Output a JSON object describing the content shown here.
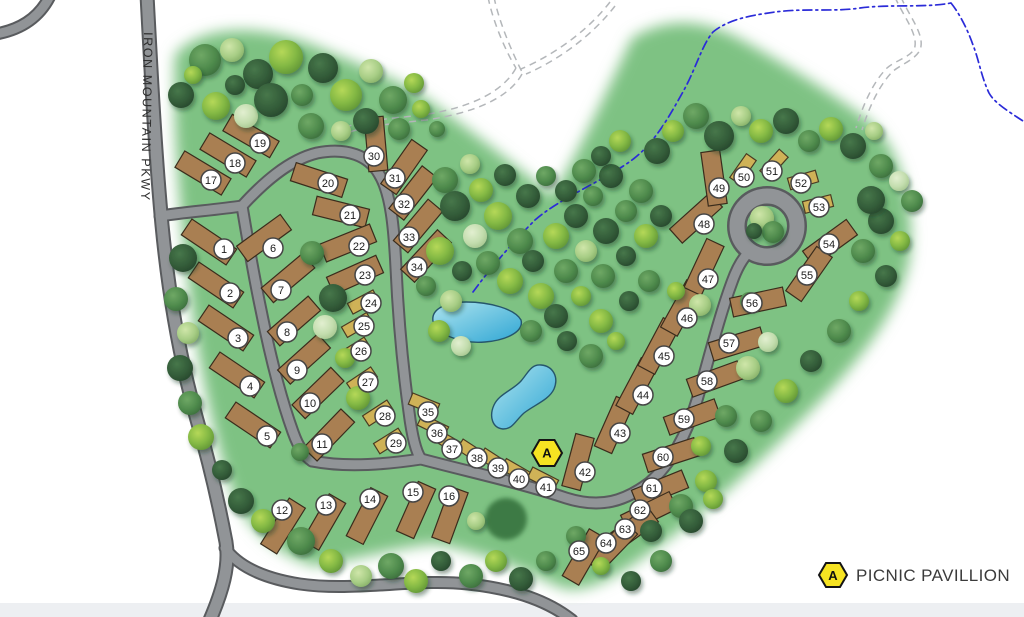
{
  "map": {
    "road_label": "IRON MOUNTAIN PKWY",
    "legend": {
      "marker": "A",
      "label": "PICNIC PAVILLION"
    },
    "pavilion": {
      "x": 547,
      "y": 453,
      "label": "A"
    },
    "colors": {
      "park_green": "#7ec283",
      "road_fill": "#919497",
      "road_casing": "#595b5e",
      "trail_gray": "#b4b7ba",
      "stream_blue": "#2b2bd8",
      "pond_light": "#9adeec",
      "pond_deep": "#2fa6d4",
      "rv_site": "#a97f52",
      "rv_site_stroke": "#3a2c1c",
      "tent_site": "#cfb257",
      "tent_site_stroke": "#4a3b22",
      "pavilion_yellow": "#f6e322",
      "label_circle_stroke": "#454545"
    },
    "sites": [
      {
        "n": "1",
        "x": 209,
        "y": 242,
        "rot": 34,
        "t": "rv",
        "lx": 224,
        "ly": 249
      },
      {
        "n": "2",
        "x": 216,
        "y": 285,
        "rot": 34,
        "t": "rv",
        "lx": 230,
        "ly": 293
      },
      {
        "n": "3",
        "x": 226,
        "y": 328,
        "rot": 34,
        "t": "rv",
        "lx": 238,
        "ly": 338
      },
      {
        "n": "4",
        "x": 237,
        "y": 375,
        "rot": 34,
        "t": "rv",
        "lx": 250,
        "ly": 386
      },
      {
        "n": "5",
        "x": 253,
        "y": 425,
        "rot": 34,
        "t": "rv",
        "lx": 267,
        "ly": 436
      },
      {
        "n": "6",
        "x": 264,
        "y": 238,
        "rot": -36,
        "t": "rv",
        "lx": 273,
        "ly": 248
      },
      {
        "n": "7",
        "x": 288,
        "y": 278,
        "rot": -40,
        "t": "rv",
        "lx": 281,
        "ly": 290
      },
      {
        "n": "8",
        "x": 294,
        "y": 321,
        "rot": -41,
        "t": "rv",
        "lx": 287,
        "ly": 332
      },
      {
        "n": "9",
        "x": 304,
        "y": 359,
        "rot": -42,
        "t": "rv",
        "lx": 297,
        "ly": 370
      },
      {
        "n": "10",
        "x": 318,
        "y": 393,
        "rot": -44,
        "t": "rv",
        "lx": 310,
        "ly": 403
      },
      {
        "n": "11",
        "x": 329,
        "y": 435,
        "rot": -46,
        "t": "rv",
        "lx": 322,
        "ly": 444
      },
      {
        "n": "12",
        "x": 283,
        "y": 526,
        "rot": -58,
        "t": "rv",
        "lx": 282,
        "ly": 510
      },
      {
        "n": "13",
        "x": 324,
        "y": 522,
        "rot": -60,
        "t": "rv",
        "lx": 326,
        "ly": 505
      },
      {
        "n": "14",
        "x": 367,
        "y": 516,
        "rot": -63,
        "t": "rv",
        "lx": 370,
        "ly": 499
      },
      {
        "n": "15",
        "x": 416,
        "y": 510,
        "rot": -66,
        "t": "rv",
        "lx": 413,
        "ly": 492
      },
      {
        "n": "16",
        "x": 450,
        "y": 515,
        "rot": -70,
        "t": "rv",
        "lx": 449,
        "ly": 496
      },
      {
        "n": "17",
        "x": 203,
        "y": 173,
        "rot": 31,
        "t": "rv",
        "lx": 211,
        "ly": 180
      },
      {
        "n": "18",
        "x": 228,
        "y": 155,
        "rot": 31,
        "t": "rv",
        "lx": 235,
        "ly": 163
      },
      {
        "n": "19",
        "x": 251,
        "y": 136,
        "rot": 30,
        "t": "rv",
        "lx": 260,
        "ly": 143
      },
      {
        "n": "20",
        "x": 319,
        "y": 180,
        "rot": 18,
        "t": "rv",
        "lx": 328,
        "ly": 183
      },
      {
        "n": "21",
        "x": 341,
        "y": 212,
        "rot": 14,
        "t": "rv",
        "lx": 350,
        "ly": 215
      },
      {
        "n": "22",
        "x": 348,
        "y": 243,
        "rot": -22,
        "t": "rv",
        "lx": 359,
        "ly": 246
      },
      {
        "n": "23",
        "x": 355,
        "y": 275,
        "rot": -24,
        "t": "rv",
        "lx": 365,
        "ly": 275
      },
      {
        "n": "24",
        "x": 363,
        "y": 302,
        "rot": -28,
        "t": "tent",
        "lx": 371,
        "ly": 303
      },
      {
        "n": "25",
        "x": 357,
        "y": 325,
        "rot": -30,
        "t": "tent",
        "lx": 364,
        "ly": 326
      },
      {
        "n": "26",
        "x": 355,
        "y": 350,
        "rot": -32,
        "t": "tent",
        "lx": 361,
        "ly": 351
      },
      {
        "n": "27",
        "x": 362,
        "y": 380,
        "rot": -34,
        "t": "tent",
        "lx": 368,
        "ly": 382
      },
      {
        "n": "28",
        "x": 378,
        "y": 413,
        "rot": -33,
        "t": "tent",
        "lx": 385,
        "ly": 416
      },
      {
        "n": "29",
        "x": 389,
        "y": 441,
        "rot": -32,
        "t": "tent",
        "lx": 396,
        "ly": 443
      },
      {
        "n": "30",
        "x": 376,
        "y": 144,
        "rot": 85,
        "t": "rv",
        "lx": 374,
        "ly": 156
      },
      {
        "n": "31",
        "x": 404,
        "y": 167,
        "rot": -55,
        "t": "rv",
        "lx": 395,
        "ly": 178
      },
      {
        "n": "32",
        "x": 413,
        "y": 193,
        "rot": -52,
        "t": "rv",
        "lx": 404,
        "ly": 204
      },
      {
        "n": "33",
        "x": 418,
        "y": 226,
        "rot": -50,
        "t": "rv",
        "lx": 409,
        "ly": 237
      },
      {
        "n": "34",
        "x": 426,
        "y": 256,
        "rot": -47,
        "t": "rv",
        "lx": 417,
        "ly": 267
      },
      {
        "n": "35",
        "x": 424,
        "y": 404,
        "rot": 22,
        "t": "tent",
        "lx": 428,
        "ly": 412
      },
      {
        "n": "36",
        "x": 433,
        "y": 426,
        "rot": 26,
        "t": "tent",
        "lx": 437,
        "ly": 433
      },
      {
        "n": "37",
        "x": 448,
        "y": 442,
        "rot": 30,
        "t": "tent",
        "lx": 452,
        "ly": 449
      },
      {
        "n": "38",
        "x": 472,
        "y": 452,
        "rot": 33,
        "t": "tent",
        "lx": 477,
        "ly": 458
      },
      {
        "n": "39",
        "x": 494,
        "y": 461,
        "rot": 33,
        "t": "tent",
        "lx": 498,
        "ly": 468
      },
      {
        "n": "40",
        "x": 516,
        "y": 471,
        "rot": 30,
        "t": "tent",
        "lx": 519,
        "ly": 479
      },
      {
        "n": "41",
        "x": 543,
        "y": 479,
        "rot": 27,
        "t": "tent",
        "lx": 546,
        "ly": 487
      },
      {
        "n": "42",
        "x": 578,
        "y": 462,
        "rot": -75,
        "t": "rv",
        "lx": 585,
        "ly": 472
      },
      {
        "n": "43",
        "x": 614,
        "y": 425,
        "rot": -66,
        "t": "rv",
        "lx": 620,
        "ly": 433
      },
      {
        "n": "44",
        "x": 637,
        "y": 386,
        "rot": -62,
        "t": "rv",
        "lx": 643,
        "ly": 395
      },
      {
        "n": "45",
        "x": 659,
        "y": 346,
        "rot": -62,
        "t": "rv",
        "lx": 664,
        "ly": 356
      },
      {
        "n": "46",
        "x": 682,
        "y": 308,
        "rot": -61,
        "t": "rv",
        "lx": 687,
        "ly": 318
      },
      {
        "n": "47",
        "x": 704,
        "y": 267,
        "rot": -65,
        "t": "rv",
        "lx": 708,
        "ly": 279
      },
      {
        "n": "48",
        "x": 696,
        "y": 218,
        "rot": -42,
        "t": "rv",
        "lx": 704,
        "ly": 224
      },
      {
        "n": "49",
        "x": 714,
        "y": 178,
        "rot": 82,
        "t": "rv",
        "lx": 719,
        "ly": 188
      },
      {
        "n": "50",
        "x": 743,
        "y": 169,
        "rot": -55,
        "t": "tent",
        "lx": 744,
        "ly": 177
      },
      {
        "n": "51",
        "x": 774,
        "y": 164,
        "rot": -48,
        "t": "tent",
        "lx": 772,
        "ly": 171
      },
      {
        "n": "52",
        "x": 803,
        "y": 180,
        "rot": -16,
        "t": "tent",
        "lx": 801,
        "ly": 183
      },
      {
        "n": "53",
        "x": 818,
        "y": 204,
        "rot": -14,
        "t": "tent",
        "lx": 819,
        "ly": 207
      },
      {
        "n": "54",
        "x": 830,
        "y": 243,
        "rot": -36,
        "t": "rv",
        "lx": 829,
        "ly": 244
      },
      {
        "n": "55",
        "x": 809,
        "y": 274,
        "rot": -55,
        "t": "rv",
        "lx": 807,
        "ly": 275
      },
      {
        "n": "56",
        "x": 758,
        "y": 302,
        "rot": -12,
        "t": "rv",
        "lx": 752,
        "ly": 303
      },
      {
        "n": "57",
        "x": 737,
        "y": 344,
        "rot": -17,
        "t": "rv",
        "lx": 729,
        "ly": 343
      },
      {
        "n": "58",
        "x": 715,
        "y": 379,
        "rot": -20,
        "t": "rv",
        "lx": 707,
        "ly": 381
      },
      {
        "n": "59",
        "x": 692,
        "y": 417,
        "rot": -20,
        "t": "rv",
        "lx": 684,
        "ly": 419
      },
      {
        "n": "60",
        "x": 671,
        "y": 455,
        "rot": -18,
        "t": "rv",
        "lx": 663,
        "ly": 457
      },
      {
        "n": "61",
        "x": 660,
        "y": 489,
        "rot": -22,
        "t": "rv",
        "lx": 652,
        "ly": 488
      },
      {
        "n": "62",
        "x": 649,
        "y": 512,
        "rot": -26,
        "t": "rv",
        "lx": 640,
        "ly": 510
      },
      {
        "n": "63",
        "x": 631,
        "y": 530,
        "rot": -36,
        "t": "rv",
        "lx": 625,
        "ly": 529
      },
      {
        "n": "64",
        "x": 612,
        "y": 547,
        "rot": -46,
        "t": "rv",
        "lx": 606,
        "ly": 543
      },
      {
        "n": "65",
        "x": 584,
        "y": 557,
        "rot": -60,
        "t": "rv",
        "lx": 579,
        "ly": 551
      }
    ],
    "trees": [
      [
        205,
        60,
        16,
        1
      ],
      [
        232,
        50,
        12,
        3
      ],
      [
        258,
        74,
        15,
        0
      ],
      [
        286,
        57,
        17,
        2
      ],
      [
        302,
        95,
        11,
        1
      ],
      [
        323,
        68,
        15,
        0
      ],
      [
        346,
        95,
        16,
        2
      ],
      [
        371,
        71,
        12,
        3
      ],
      [
        393,
        100,
        14,
        1
      ],
      [
        414,
        83,
        10,
        2
      ],
      [
        181,
        95,
        13,
        0
      ],
      [
        216,
        106,
        14,
        2
      ],
      [
        246,
        116,
        12,
        4
      ],
      [
        271,
        100,
        17,
        0
      ],
      [
        311,
        126,
        13,
        1
      ],
      [
        341,
        131,
        10,
        3
      ],
      [
        366,
        121,
        13,
        0
      ],
      [
        399,
        129,
        11,
        1
      ],
      [
        421,
        109,
        9,
        2
      ],
      [
        437,
        129,
        8,
        1
      ],
      [
        235,
        85,
        10,
        0
      ],
      [
        193,
        75,
        9,
        2
      ],
      [
        183,
        258,
        14,
        0
      ],
      [
        176,
        299,
        12,
        1
      ],
      [
        188,
        333,
        11,
        3
      ],
      [
        180,
        368,
        13,
        0
      ],
      [
        190,
        403,
        12,
        1
      ],
      [
        201,
        437,
        13,
        2
      ],
      [
        222,
        470,
        10,
        0
      ],
      [
        312,
        253,
        12,
        1
      ],
      [
        333,
        298,
        14,
        0
      ],
      [
        325,
        327,
        12,
        4
      ],
      [
        345,
        358,
        10,
        2
      ],
      [
        358,
        398,
        12,
        2
      ],
      [
        300,
        452,
        9,
        1
      ],
      [
        445,
        180,
        13,
        1
      ],
      [
        470,
        164,
        10,
        3
      ],
      [
        455,
        206,
        15,
        0
      ],
      [
        481,
        190,
        12,
        2
      ],
      [
        505,
        175,
        11,
        0
      ],
      [
        498,
        216,
        14,
        2
      ],
      [
        528,
        196,
        12,
        0
      ],
      [
        546,
        176,
        10,
        1
      ],
      [
        520,
        241,
        13,
        1
      ],
      [
        475,
        236,
        12,
        4
      ],
      [
        440,
        251,
        14,
        2
      ],
      [
        462,
        271,
        10,
        0
      ],
      [
        488,
        263,
        12,
        1
      ],
      [
        510,
        281,
        13,
        2
      ],
      [
        533,
        261,
        11,
        0
      ],
      [
        556,
        236,
        13,
        2
      ],
      [
        576,
        216,
        12,
        0
      ],
      [
        593,
        196,
        10,
        1
      ],
      [
        611,
        176,
        12,
        0
      ],
      [
        566,
        271,
        12,
        1
      ],
      [
        541,
        296,
        13,
        2
      ],
      [
        586,
        251,
        11,
        3
      ],
      [
        606,
        231,
        13,
        0
      ],
      [
        626,
        211,
        11,
        1
      ],
      [
        451,
        301,
        11,
        3
      ],
      [
        426,
        286,
        10,
        1
      ],
      [
        556,
        316,
        12,
        0
      ],
      [
        581,
        296,
        10,
        2
      ],
      [
        603,
        276,
        12,
        1
      ],
      [
        626,
        256,
        10,
        0
      ],
      [
        646,
        236,
        12,
        2
      ],
      [
        661,
        216,
        11,
        0
      ],
      [
        439,
        331,
        11,
        2
      ],
      [
        461,
        346,
        10,
        4
      ],
      [
        531,
        331,
        11,
        1
      ],
      [
        601,
        321,
        12,
        2
      ],
      [
        629,
        301,
        10,
        0
      ],
      [
        649,
        281,
        11,
        1
      ],
      [
        567,
        341,
        10,
        0
      ],
      [
        591,
        356,
        12,
        1
      ],
      [
        616,
        341,
        9,
        2
      ],
      [
        657,
        151,
        13,
        0
      ],
      [
        673,
        131,
        11,
        2
      ],
      [
        696,
        116,
        13,
        1
      ],
      [
        719,
        136,
        15,
        0
      ],
      [
        741,
        116,
        10,
        3
      ],
      [
        761,
        131,
        12,
        2
      ],
      [
        786,
        121,
        13,
        0
      ],
      [
        809,
        141,
        11,
        1
      ],
      [
        831,
        129,
        12,
        2
      ],
      [
        853,
        146,
        13,
        0
      ],
      [
        874,
        131,
        9,
        3
      ],
      [
        641,
        191,
        12,
        1
      ],
      [
        620,
        141,
        11,
        2
      ],
      [
        601,
        156,
        10,
        0
      ],
      [
        584,
        171,
        12,
        1
      ],
      [
        566,
        191,
        11,
        0
      ],
      [
        881,
        166,
        12,
        1
      ],
      [
        899,
        181,
        10,
        4
      ],
      [
        912,
        201,
        11,
        1
      ],
      [
        881,
        221,
        13,
        0
      ],
      [
        900,
        241,
        10,
        2
      ],
      [
        863,
        251,
        12,
        1
      ],
      [
        886,
        276,
        11,
        0
      ],
      [
        859,
        301,
        10,
        2
      ],
      [
        839,
        331,
        12,
        1
      ],
      [
        811,
        361,
        11,
        0
      ],
      [
        786,
        391,
        12,
        2
      ],
      [
        871,
        200,
        14,
        0
      ],
      [
        762,
        218,
        12,
        3
      ],
      [
        773,
        232,
        11,
        1
      ],
      [
        754,
        231,
        8,
        0
      ],
      [
        748,
        368,
        12,
        3
      ],
      [
        768,
        342,
        10,
        4
      ],
      [
        700,
        305,
        11,
        3
      ],
      [
        676,
        291,
        9,
        2
      ],
      [
        726,
        416,
        11,
        1
      ],
      [
        701,
        446,
        10,
        2
      ],
      [
        749,
        301,
        9,
        1
      ],
      [
        761,
        421,
        11,
        1
      ],
      [
        736,
        451,
        12,
        0
      ],
      [
        706,
        481,
        11,
        2
      ],
      [
        681,
        506,
        12,
        1
      ],
      [
        651,
        531,
        11,
        0
      ],
      [
        241,
        501,
        13,
        0
      ],
      [
        263,
        521,
        12,
        2
      ],
      [
        301,
        541,
        14,
        1
      ],
      [
        331,
        561,
        12,
        2
      ],
      [
        361,
        576,
        11,
        3
      ],
      [
        391,
        566,
        13,
        1
      ],
      [
        416,
        581,
        12,
        2
      ],
      [
        441,
        561,
        10,
        0
      ],
      [
        471,
        576,
        12,
        1
      ],
      [
        496,
        561,
        11,
        2
      ],
      [
        521,
        579,
        12,
        0
      ],
      [
        546,
        561,
        10,
        1
      ],
      [
        691,
        521,
        12,
        0
      ],
      [
        713,
        499,
        10,
        2
      ],
      [
        661,
        561,
        11,
        1
      ],
      [
        631,
        581,
        10,
        0
      ],
      [
        601,
        566,
        9,
        2
      ],
      [
        576,
        536,
        10,
        1
      ],
      [
        476,
        521,
        9,
        3
      ]
    ]
  }
}
